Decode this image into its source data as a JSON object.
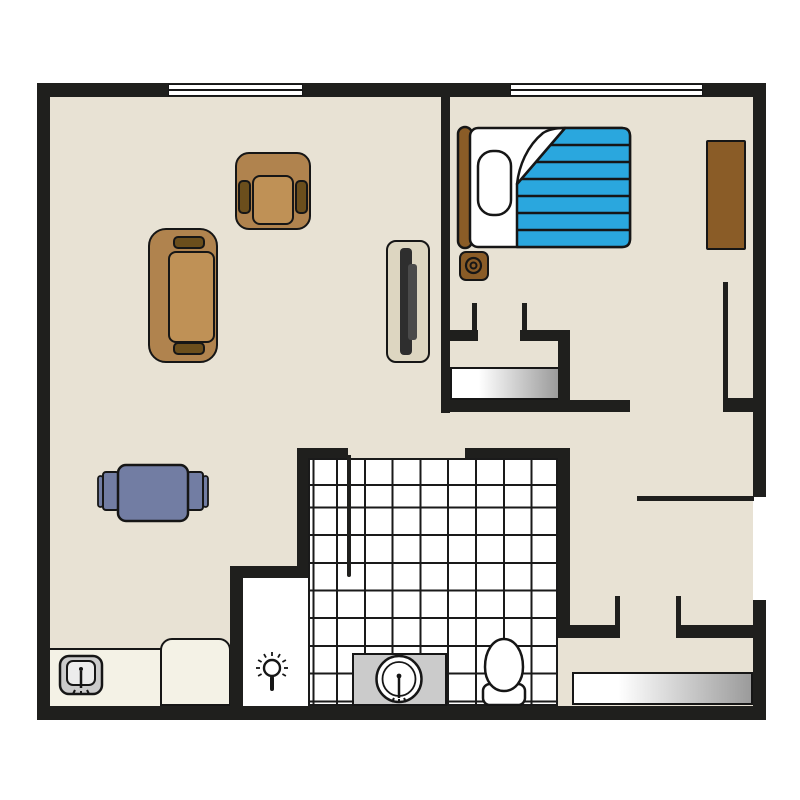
{
  "title": "apartment-floor-plan",
  "colors": {
    "canvas": "#ffffff",
    "wall": "#1f1f1d",
    "outline": "#161616",
    "floor": "#e8e2d4",
    "counter": "#f4f2e6",
    "tile_bg": "#ffffff",
    "tile_line": "#1a1a1a",
    "sofa_body": "#b0834e",
    "sofa_seat": "#bf9156",
    "sofa_arm": "#6b4e1c",
    "wood_deep": "#8a5c27",
    "blanket": "#2aa7de",
    "table": "#727da3",
    "fixture": "#cbcbcb",
    "fixture_inner": "#ececec",
    "tv_stand": "#ddd6c1",
    "tv_screen": "#2e2e2e",
    "tv_screen_back": "#4a4a4a",
    "mat_end": "#9b9b9b"
  },
  "objects": {
    "living_area": [
      "sofa",
      "armchair",
      "tv",
      "dining-table",
      "dining-chairs"
    ],
    "kitchen": [
      "counter",
      "kitchen-sink"
    ],
    "bedroom": [
      "headboard",
      "bed",
      "pillow",
      "blanket-folded-corner",
      "nightstand",
      "dresser",
      "closet-sliding-doors"
    ],
    "bathroom": [
      "tiled-floor",
      "shower-partition",
      "shower-head",
      "vanity-sink",
      "toilet"
    ],
    "entry_hall": [
      "entry-mat",
      "door-openings",
      "windows"
    ]
  }
}
